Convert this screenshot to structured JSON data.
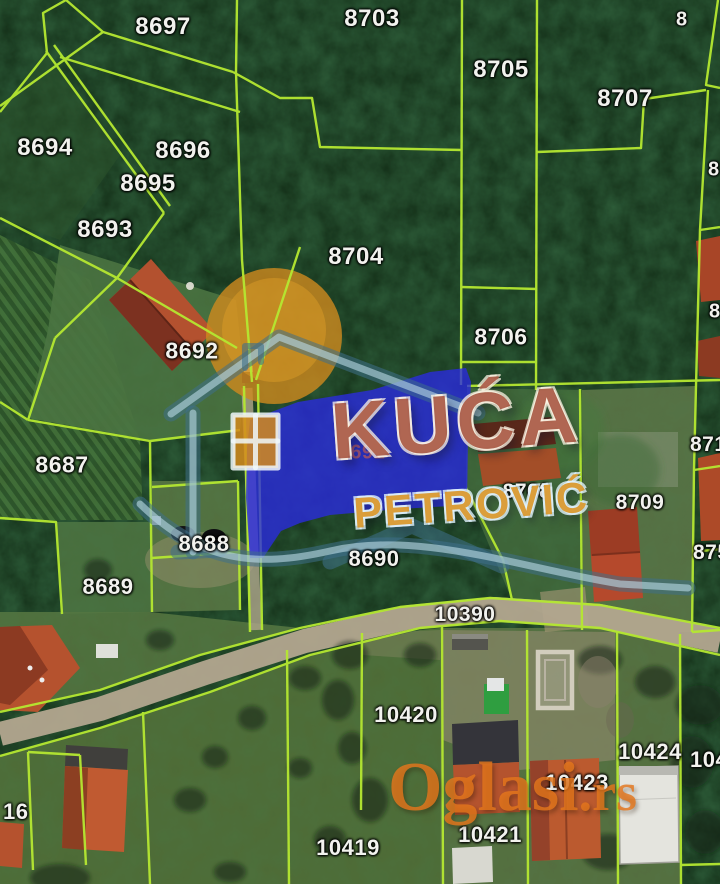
{
  "map": {
    "kind": "satellite-cadastral-parcel-map",
    "highlighted_parcel": "8691",
    "road_parcel": "10390"
  },
  "watermarks": {
    "agency_line1": "KUĆA",
    "agency_line2": "PETROVIĆ",
    "site_name": "Oglasi",
    "site_tld": ".rs"
  },
  "colors": {
    "boundary": "#b5e831",
    "highlight": "#2a2ae1",
    "sun": "#d08a1e",
    "road": "#b3a78f",
    "logo-title": "#9c4230",
    "logo-sub": "#d8921f",
    "oglasi": "#e4761c",
    "forest": "#142f18",
    "roof": "#b5492c"
  },
  "parcels": [
    {
      "label": "8697",
      "x": 163,
      "y": 27,
      "s": 24
    },
    {
      "label": "8703",
      "x": 372,
      "y": 19,
      "s": 24
    },
    {
      "label": "8705",
      "x": 501,
      "y": 70,
      "s": 24
    },
    {
      "label": "8707",
      "x": 625,
      "y": 99,
      "s": 24
    },
    {
      "label": "8694",
      "x": 45,
      "y": 148,
      "s": 24
    },
    {
      "label": "8696",
      "x": 183,
      "y": 151,
      "s": 24
    },
    {
      "label": "8695",
      "x": 148,
      "y": 184,
      "s": 24
    },
    {
      "label": "8693",
      "x": 105,
      "y": 230,
      "s": 24
    },
    {
      "label": "8704",
      "x": 356,
      "y": 257,
      "s": 24
    },
    {
      "label": "8706",
      "x": 501,
      "y": 337,
      "s": 23
    },
    {
      "label": "8692",
      "x": 192,
      "y": 351,
      "s": 23
    },
    {
      "label": "8687",
      "x": 62,
      "y": 465,
      "s": 23
    },
    {
      "label": "8691",
      "x": 362,
      "y": 453,
      "s": 20,
      "v": "faint"
    },
    {
      "label": "8708",
      "x": 527,
      "y": 492,
      "s": 21
    },
    {
      "label": "8709",
      "x": 640,
      "y": 503,
      "s": 21
    },
    {
      "label": "8688",
      "x": 204,
      "y": 544,
      "s": 22
    },
    {
      "label": "8690",
      "x": 374,
      "y": 559,
      "s": 22
    },
    {
      "label": "8689",
      "x": 108,
      "y": 587,
      "s": 22
    },
    {
      "label": "10390",
      "x": 465,
      "y": 615,
      "s": 21
    },
    {
      "label": "10420",
      "x": 406,
      "y": 715,
      "s": 22
    },
    {
      "label": "10424",
      "x": 650,
      "y": 752,
      "s": 22
    },
    {
      "label": "10423",
      "x": 577,
      "y": 783,
      "s": 22
    },
    {
      "label": "10421",
      "x": 490,
      "y": 835,
      "s": 22
    },
    {
      "label": "10419",
      "x": 348,
      "y": 848,
      "s": 22
    },
    {
      "label": "16",
      "x": 3,
      "y": 812,
      "s": 22,
      "v": "edge"
    },
    {
      "label": "8",
      "x": 676,
      "y": 20,
      "s": 20,
      "v": "edge"
    },
    {
      "label": "8",
      "x": 708,
      "y": 170,
      "s": 20,
      "v": "edge"
    },
    {
      "label": "8",
      "x": 709,
      "y": 312,
      "s": 20,
      "v": "edge"
    },
    {
      "label": "871",
      "x": 690,
      "y": 445,
      "s": 21,
      "v": "edge"
    },
    {
      "label": "875",
      "x": 693,
      "y": 553,
      "s": 21,
      "v": "edge"
    },
    {
      "label": "104",
      "x": 690,
      "y": 760,
      "s": 22,
      "v": "edge"
    }
  ]
}
